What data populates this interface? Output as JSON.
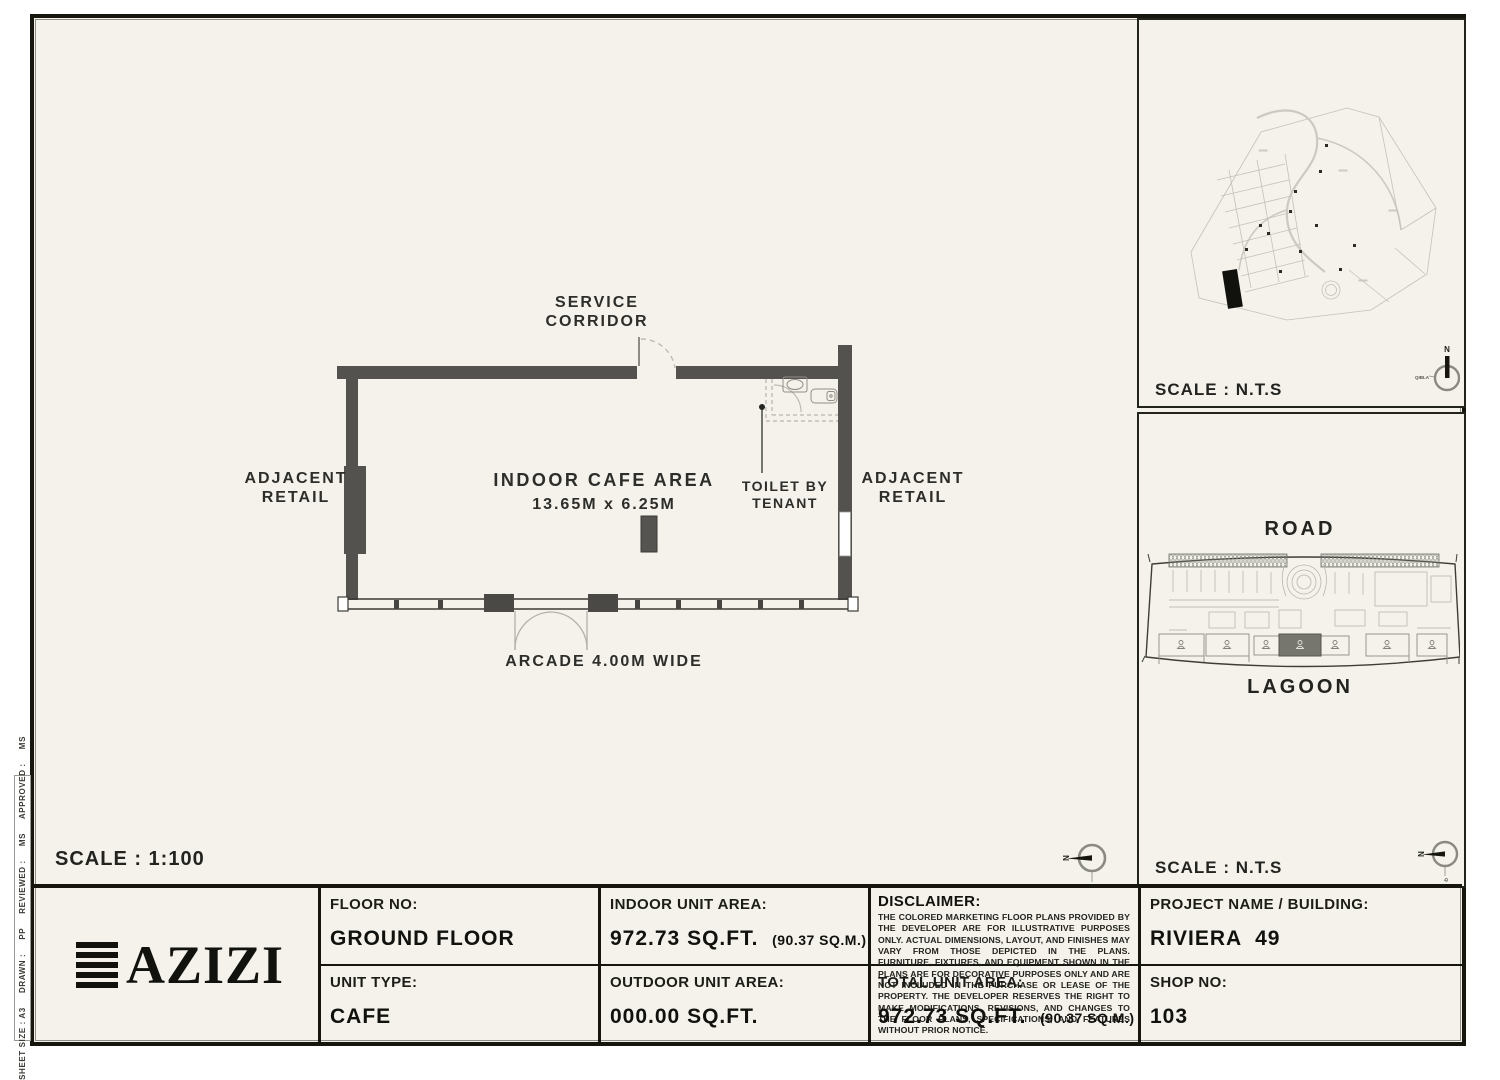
{
  "colors": {
    "paper": "#f4f2eb",
    "frame": "#16160f",
    "wall": "#54524e",
    "highlight_unit": "#76766e",
    "light_line": "#b9b7ae"
  },
  "side_info": {
    "text": "SHEET SIZE : A3     DRAWN :     PP     REVIEWED :     MS     APPROVED :     MS"
  },
  "floor_plan": {
    "service_corridor_1": "SERVICE",
    "service_corridor_2": "CORRIDOR",
    "adjacent_retail_1": "ADJACENT",
    "adjacent_retail_2": "RETAIL",
    "indoor_cafe_line1": "INDOOR CAFE AREA",
    "indoor_cafe_line2": "13.65M x 6.25M",
    "toilet_line1": "TOILET BY",
    "toilet_line2": "TENANT",
    "arcade": "ARCADE 4.00M WIDE",
    "scale": "SCALE : 1:100",
    "compass_n": "N",
    "compass_qibla": "QIBLA"
  },
  "site_map_panel": {
    "scale": "SCALE : N.T.S",
    "compass_n": "N",
    "compass_qibla": "QIBLA"
  },
  "key_plan_panel": {
    "road": "ROAD",
    "lagoon": "LAGOON",
    "scale": "SCALE : N.T.S",
    "compass_n": "N",
    "compass_qibla": "QIBLA"
  },
  "title_block": {
    "logo_text": "AZIZI",
    "floor_no_label": "FLOOR NO:",
    "floor_no_value": "GROUND FLOOR",
    "unit_type_label": "UNIT TYPE:",
    "unit_type_value": "CAFE",
    "indoor_label": "INDOOR UNIT AREA:",
    "indoor_value": "972.73 SQ.FT.",
    "indoor_sub": "(90.37 SQ.M.)",
    "outdoor_label": "OUTDOOR UNIT AREA:",
    "outdoor_value": "000.00 SQ.FT.",
    "disclaimer_label": "DISCLAIMER:",
    "disclaimer_text": "THE COLORED MARKETING FLOOR PLANS PROVIDED BY THE DEVELOPER ARE FOR ILLUSTRATIVE PURPOSES ONLY. ACTUAL DIMENSIONS, LAYOUT, AND FINISHES MAY VARY FROM THOSE DEPICTED IN THE PLANS. FURNITURE, FIXTURES, AND EQUIPMENT SHOWN IN THE PLANS ARE FOR DECORATIVE PURPOSES ONLY AND ARE NOT INCLUDED IN THE PURCHASE OR LEASE OF THE PROPERTY. THE DEVELOPER RESERVES THE RIGHT TO MAKE MODIFICATIONS, REVISIONS, AND CHANGES TO THE FLOOR PLANS, SPECIFICATIONS, AND FEATURES WITHOUT PRIOR NOTICE.",
    "total_label": "TOTAL UNIT AREA:",
    "total_value": "972.73 SQ.FT.",
    "total_sub": "(90.37 SQ.M.)",
    "project_label": "PROJECT NAME / BUILDING:",
    "project_value": "RIVIERA  49",
    "shop_label": "SHOP NO:",
    "shop_value": "103"
  }
}
